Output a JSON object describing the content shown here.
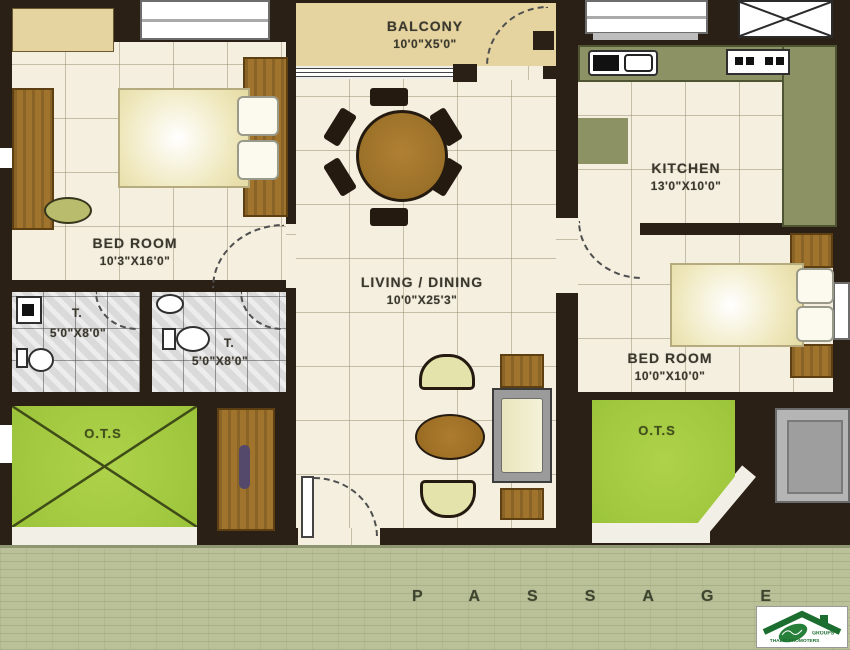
{
  "plan": {
    "balcony": {
      "label": "BALCONY",
      "dims": "10'0\"X5'0\""
    },
    "bedroom1": {
      "label": "BED ROOM",
      "dims": "10'3\"X16'0\""
    },
    "kitchen": {
      "label": "KITCHEN",
      "dims": "13'0\"X10'0\""
    },
    "living": {
      "label": "LIVING / DINING",
      "dims": "10'0\"X25'3\""
    },
    "bedroom2": {
      "label": "BED ROOM",
      "dims": "10'0\"X10'0\""
    },
    "toilet1": {
      "label": "T.",
      "dims": "5'0\"X8'0\""
    },
    "toilet2": {
      "label": "T.",
      "dims": "5'0\"X8'0\""
    },
    "ots1": {
      "label": "O.T.S"
    },
    "ots2": {
      "label": "O.T.S"
    },
    "passage": {
      "label": "PASSAGE"
    }
  },
  "logo": {
    "line1": "GROUPS",
    "line2": "THALIS PROMOTERS"
  },
  "colors": {
    "wall": "#2b2015",
    "floor": "#f4efdf",
    "balcony": "#e6d4a0",
    "counter": "#8d9264",
    "ots": "#a6cc44",
    "passage": "#bac198",
    "wood": "#a0742c",
    "logo_green": "#1c6e30"
  }
}
